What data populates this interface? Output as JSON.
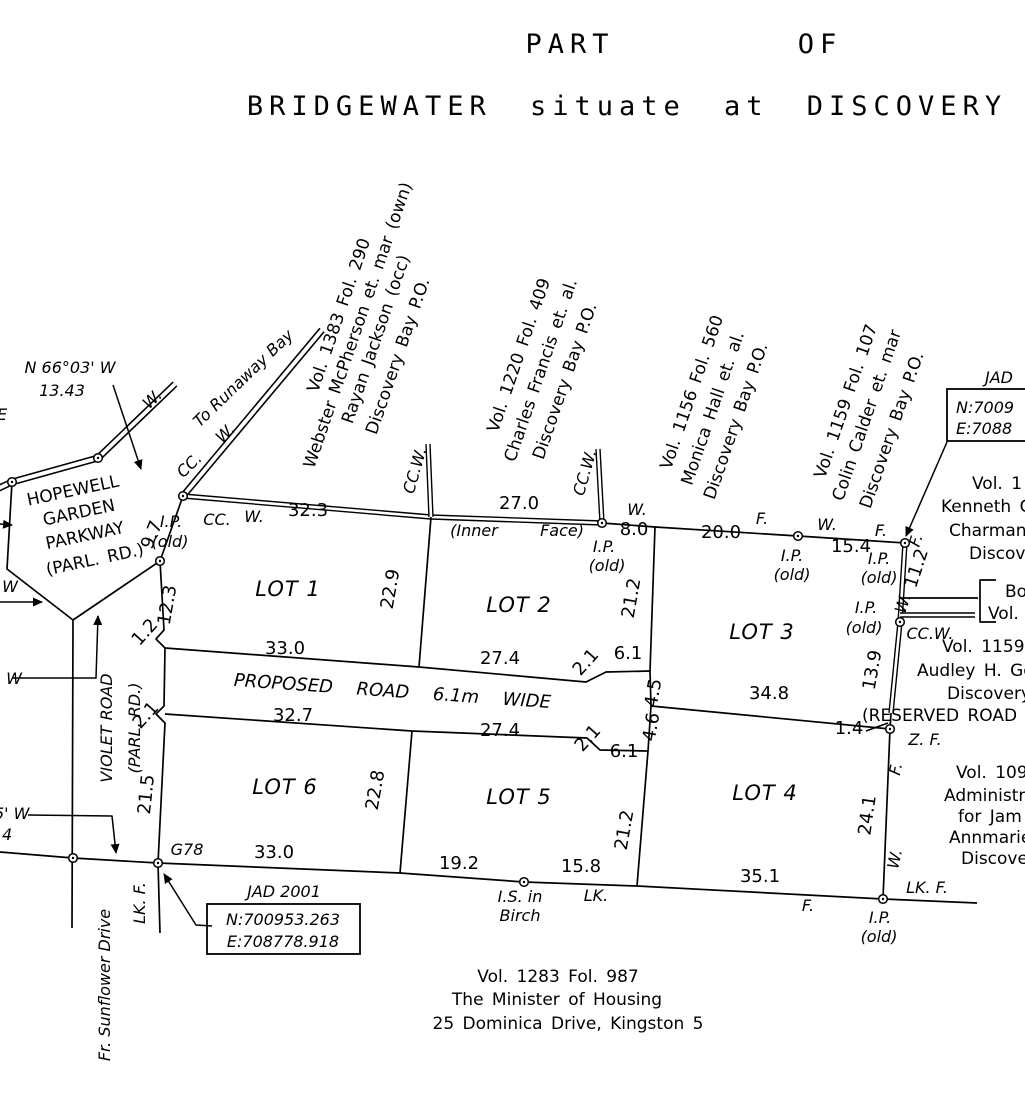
{
  "title": {
    "part": "PART",
    "of": "OF",
    "subtitle": "BRIDGEWATER  situate  at  DISCOVERY"
  },
  "boxes": {
    "jad2001": {
      "caption": "JAD  2001",
      "north": "N:700953.263",
      "east": "E:708778.918"
    },
    "jad_right": {
      "caption": "JAD",
      "north": "N:7009",
      "east": "E:7088"
    }
  },
  "labels": {
    "bearings": [
      {
        "t": "N 66°03' W",
        "x": 70,
        "y": 373,
        "c": "ital"
      },
      {
        "t": "13.43",
        "x": 62,
        "y": 396,
        "c": "ital"
      },
      {
        "t": "E",
        "x": -3,
        "y": 420,
        "c": "ital",
        "a": "s"
      },
      {
        "t": "W",
        "x": 10,
        "y": 592,
        "c": "ital"
      },
      {
        "t": "W",
        "x": 14,
        "y": 684,
        "c": "ital"
      },
      {
        "t": "5'  W",
        "x": -6,
        "y": 819,
        "c": "ital",
        "a": "s"
      },
      {
        "t": "4",
        "x": 2,
        "y": 840,
        "c": "ital",
        "a": "s"
      }
    ],
    "roads": [
      {
        "t": "W.",
        "x": 156,
        "y": 403,
        "r": -44,
        "c": "ital"
      },
      {
        "t": "To Runaway Bay",
        "x": 247,
        "y": 382,
        "r": -44,
        "c": "ital"
      },
      {
        "t": "CC.",
        "x": 193,
        "y": 469,
        "r": -44,
        "c": "ital"
      },
      {
        "t": "W.",
        "x": 229,
        "y": 437,
        "r": -44,
        "c": "ital"
      },
      {
        "t": "HOPEWELL",
        "x": 74,
        "y": 496,
        "r": -12,
        "c": "name"
      },
      {
        "t": "GARDEN",
        "x": 80,
        "y": 518,
        "r": -12,
        "c": "name"
      },
      {
        "t": "PARKWAY",
        "x": 86,
        "y": 541,
        "r": -12,
        "c": "name"
      },
      {
        "t": "(PARL. RD.)",
        "x": 96,
        "y": 565,
        "r": -12,
        "c": "name"
      },
      {
        "t": "VIOLET ROAD",
        "x": 112,
        "y": 728,
        "r": -90,
        "c": "ital"
      },
      {
        "t": "(PARL. RD.)",
        "x": 140,
        "y": 728,
        "r": -90,
        "c": "ital"
      },
      {
        "t": "Fr. Sunflower Drive",
        "x": 110,
        "y": 985,
        "r": -90,
        "c": "ital"
      },
      {
        "t": "PROPOSED   ROAD   6.1m   WIDE",
        "x": 392,
        "y": 697,
        "r": 4,
        "c": "road"
      }
    ],
    "lot_names": [
      {
        "t": "LOT  1",
        "x": 288,
        "y": 596,
        "c": "lot"
      },
      {
        "t": "LOT  2",
        "x": 519,
        "y": 612,
        "c": "lot"
      },
      {
        "t": "LOT  3",
        "x": 762,
        "y": 639,
        "c": "lot"
      },
      {
        "t": "LOT  4",
        "x": 765,
        "y": 800,
        "c": "lot"
      },
      {
        "t": "LOT  5",
        "x": 519,
        "y": 804,
        "c": "lot"
      },
      {
        "t": "LOT  6",
        "x": 285,
        "y": 794,
        "c": "lot"
      }
    ],
    "measurements": [
      {
        "t": "9.7",
        "x": 157,
        "y": 537,
        "r": -68,
        "c": "meas"
      },
      {
        "t": "12.3",
        "x": 173,
        "y": 606,
        "r": -80,
        "c": "meas"
      },
      {
        "t": "1.2",
        "x": 149,
        "y": 636,
        "r": -48,
        "c": "meas"
      },
      {
        "t": "2.1",
        "x": 150,
        "y": 719,
        "r": -48,
        "c": "meas"
      },
      {
        "t": "21.5",
        "x": 152,
        "y": 795,
        "r": -84,
        "c": "meas"
      },
      {
        "t": "32.3",
        "x": 308,
        "y": 516,
        "c": "meas"
      },
      {
        "t": "27.0",
        "x": 519,
        "y": 509,
        "c": "meas"
      },
      {
        "t": "8.0",
        "x": 634,
        "y": 535,
        "c": "meas"
      },
      {
        "t": "20.0",
        "x": 721,
        "y": 538,
        "c": "meas"
      },
      {
        "t": "15.4",
        "x": 851,
        "y": 552,
        "c": "meas"
      },
      {
        "t": "11.2",
        "x": 922,
        "y": 570,
        "r": -72,
        "c": "meas"
      },
      {
        "t": "22.9",
        "x": 396,
        "y": 590,
        "r": -80,
        "c": "meas"
      },
      {
        "t": "21.2",
        "x": 637,
        "y": 599,
        "r": -80,
        "c": "meas"
      },
      {
        "t": "13.9",
        "x": 878,
        "y": 671,
        "r": -80,
        "c": "meas"
      },
      {
        "t": "33.0",
        "x": 285,
        "y": 654,
        "c": "meas"
      },
      {
        "t": "27.4",
        "x": 500,
        "y": 664,
        "c": "meas"
      },
      {
        "t": "2.1",
        "x": 590,
        "y": 666,
        "r": -48,
        "c": "meas"
      },
      {
        "t": "6.1",
        "x": 628,
        "y": 659,
        "c": "meas"
      },
      {
        "t": "32.7",
        "x": 293,
        "y": 721,
        "c": "meas"
      },
      {
        "t": "27.4",
        "x": 500,
        "y": 736,
        "c": "meas"
      },
      {
        "t": "2.1",
        "x": 592,
        "y": 742,
        "r": -48,
        "c": "meas"
      },
      {
        "t": "6.1",
        "x": 624,
        "y": 757,
        "c": "meas"
      },
      {
        "t": "4.5",
        "x": 659,
        "y": 694,
        "r": -80,
        "c": "meas"
      },
      {
        "t": "4.6",
        "x": 657,
        "y": 728,
        "r": -80,
        "c": "meas"
      },
      {
        "t": "34.8",
        "x": 769,
        "y": 699,
        "c": "meas"
      },
      {
        "t": "1.4",
        "x": 849,
        "y": 734,
        "c": "meas"
      },
      {
        "t": "21.2",
        "x": 630,
        "y": 831,
        "r": -80,
        "c": "meas"
      },
      {
        "t": "24.1",
        "x": 873,
        "y": 816,
        "r": -82,
        "c": "meas"
      },
      {
        "t": "22.8",
        "x": 381,
        "y": 791,
        "r": -80,
        "c": "meas"
      },
      {
        "t": "33.0",
        "x": 274,
        "y": 858,
        "c": "meas"
      },
      {
        "t": "19.2",
        "x": 459,
        "y": 869,
        "c": "meas"
      },
      {
        "t": "15.8",
        "x": 581,
        "y": 872,
        "c": "meas"
      },
      {
        "t": "35.1",
        "x": 760,
        "y": 882,
        "c": "meas"
      }
    ],
    "point_marks": [
      {
        "t": "I.P.",
        "x": 171,
        "y": 527,
        "c": "ital"
      },
      {
        "t": "(old)",
        "x": 170,
        "y": 547,
        "c": "ital"
      },
      {
        "t": "CC.",
        "x": 217,
        "y": 525,
        "c": "ital"
      },
      {
        "t": "W.",
        "x": 254,
        "y": 522,
        "c": "ital"
      },
      {
        "t": "CC.W.",
        "x": 420,
        "y": 472,
        "r": -74,
        "c": "ital"
      },
      {
        "t": "(Inner",
        "x": 474,
        "y": 536,
        "c": "ital"
      },
      {
        "t": "Face)",
        "x": 562,
        "y": 536,
        "c": "ital"
      },
      {
        "t": "CC.W.",
        "x": 590,
        "y": 474,
        "r": -74,
        "c": "ital"
      },
      {
        "t": "I.P.",
        "x": 604,
        "y": 552,
        "c": "ital"
      },
      {
        "t": "(old)",
        "x": 607,
        "y": 571,
        "c": "ital"
      },
      {
        "t": "W.",
        "x": 637,
        "y": 515,
        "c": "ital"
      },
      {
        "t": "F.",
        "x": 762,
        "y": 524,
        "c": "ital"
      },
      {
        "t": "I.P.",
        "x": 792,
        "y": 561,
        "c": "ital"
      },
      {
        "t": "(old)",
        "x": 792,
        "y": 580,
        "c": "ital"
      },
      {
        "t": "W.",
        "x": 827,
        "y": 530,
        "c": "ital"
      },
      {
        "t": "I.P.",
        "x": 879,
        "y": 564,
        "c": "ital"
      },
      {
        "t": "(old)",
        "x": 879,
        "y": 583,
        "c": "ital"
      },
      {
        "t": "F.",
        "x": 881,
        "y": 536,
        "c": "ital"
      },
      {
        "t": "F.",
        "x": 921,
        "y": 542,
        "r": -72,
        "c": "ital"
      },
      {
        "t": "W.",
        "x": 908,
        "y": 605,
        "r": -72,
        "c": "ital"
      },
      {
        "t": "I.P.",
        "x": 866,
        "y": 613,
        "c": "ital"
      },
      {
        "t": "(old)",
        "x": 864,
        "y": 633,
        "c": "ital"
      },
      {
        "t": "CC.W.",
        "x": 930,
        "y": 639,
        "c": "ital"
      },
      {
        "t": "Z.  F.",
        "x": 925,
        "y": 745,
        "c": "ital"
      },
      {
        "t": "F.",
        "x": 901,
        "y": 770,
        "r": -78,
        "c": "ital"
      },
      {
        "t": "W.",
        "x": 900,
        "y": 860,
        "r": -78,
        "c": "ital"
      },
      {
        "t": "LK.  F.",
        "x": 927,
        "y": 893,
        "c": "ital"
      },
      {
        "t": "I.P.",
        "x": 880,
        "y": 923,
        "c": "ital"
      },
      {
        "t": "(old)",
        "x": 879,
        "y": 942,
        "c": "ital"
      },
      {
        "t": "LK.",
        "x": 596,
        "y": 901,
        "c": "ital"
      },
      {
        "t": "I.S.  in",
        "x": 520,
        "y": 902,
        "c": "ital"
      },
      {
        "t": "Birch",
        "x": 520,
        "y": 921,
        "c": "ital"
      },
      {
        "t": "F.",
        "x": 808,
        "y": 911,
        "c": "ital"
      },
      {
        "t": "G78",
        "x": 187,
        "y": 855,
        "c": "ital"
      },
      {
        "t": "LK. F.",
        "x": 145,
        "y": 903,
        "r": -90,
        "c": "ital"
      }
    ],
    "owners": [
      {
        "t": "Vol. 1383 Fol. 290",
        "x": 344,
        "y": 317,
        "r": -71,
        "c": "name"
      },
      {
        "t": "Webster McPherson et. mar (own)",
        "x": 363,
        "y": 327,
        "r": -71,
        "c": "name"
      },
      {
        "t": "Rayan Jackson (occ)",
        "x": 381,
        "y": 341,
        "r": -71,
        "c": "name"
      },
      {
        "t": "Discovery Bay P.O.",
        "x": 403,
        "y": 358,
        "r": -71,
        "c": "name"
      },
      {
        "t": "Vol. 1220 Fol. 409",
        "x": 524,
        "y": 357,
        "r": -71,
        "c": "name"
      },
      {
        "t": "Charles Francis et. al.",
        "x": 546,
        "y": 372,
        "r": -71,
        "c": "name"
      },
      {
        "t": "Discovery Bay P.O.",
        "x": 570,
        "y": 383,
        "r": -71,
        "c": "name"
      },
      {
        "t": "Vol. 1156 Fol. 560",
        "x": 697,
        "y": 394,
        "r": -71,
        "c": "name"
      },
      {
        "t": "Monica Hall et. al.",
        "x": 718,
        "y": 410,
        "r": -71,
        "c": "name"
      },
      {
        "t": "Discovery Bay P.O.",
        "x": 741,
        "y": 423,
        "r": -71,
        "c": "name"
      },
      {
        "t": "Vol. 1159 Fol. 107",
        "x": 851,
        "y": 403,
        "r": -71,
        "c": "name"
      },
      {
        "t": "Colin Calder et. mar",
        "x": 872,
        "y": 417,
        "r": -71,
        "c": "name"
      },
      {
        "t": "Discovery Bay P.O.",
        "x": 897,
        "y": 432,
        "r": -71,
        "c": "name"
      }
    ],
    "margin_notes": [
      {
        "t": "Vol. 1",
        "x": 972,
        "y": 489,
        "a": "s",
        "c": "name"
      },
      {
        "t": "Kenneth Ca",
        "x": 941,
        "y": 512,
        "a": "s",
        "c": "name"
      },
      {
        "t": "Charmane",
        "x": 949,
        "y": 536,
        "a": "s",
        "c": "name"
      },
      {
        "t": "Discove",
        "x": 969,
        "y": 559,
        "a": "s",
        "c": "name"
      },
      {
        "t": "Bo",
        "x": 1005,
        "y": 597,
        "a": "s",
        "c": "name"
      },
      {
        "t": "Vol.",
        "x": 988,
        "y": 619,
        "a": "s",
        "c": "name"
      },
      {
        "t": "Vol. 1159",
        "x": 942,
        "y": 652,
        "a": "s",
        "c": "name"
      },
      {
        "t": "Audley H. Gor",
        "x": 917,
        "y": 676,
        "a": "s",
        "c": "name"
      },
      {
        "t": "Discovery",
        "x": 947,
        "y": 699,
        "a": "s",
        "c": "name"
      },
      {
        "t": "(RESERVED ROAD",
        "x": 862,
        "y": 721,
        "a": "s",
        "c": "name"
      },
      {
        "t": "Vol. 109",
        "x": 956,
        "y": 778,
        "a": "s",
        "c": "name"
      },
      {
        "t": "Administrat",
        "x": 944,
        "y": 801,
        "a": "s",
        "c": "name"
      },
      {
        "t": "for Jam",
        "x": 958,
        "y": 822,
        "a": "s",
        "c": "name"
      },
      {
        "t": "Annmarie",
        "x": 949,
        "y": 843,
        "a": "s",
        "c": "name"
      },
      {
        "t": "Discovery",
        "x": 961,
        "y": 864,
        "a": "s",
        "c": "name"
      }
    ],
    "footer": [
      {
        "t": "Vol. 1283 Fol. 987",
        "x": 558,
        "y": 982,
        "c": "name"
      },
      {
        "t": "The Minister of Housing",
        "x": 557,
        "y": 1005,
        "c": "name"
      },
      {
        "t": "25 Dominica Drive, Kingston 5",
        "x": 568,
        "y": 1029,
        "c": "name"
      }
    ]
  },
  "survey_points": [
    [
      12,
      482
    ],
    [
      98,
      458
    ],
    [
      183,
      496
    ],
    [
      160,
      561
    ],
    [
      602,
      523
    ],
    [
      798,
      536
    ],
    [
      905,
      543
    ],
    [
      900,
      622
    ],
    [
      890,
      729
    ],
    [
      883,
      899
    ],
    [
      524,
      882
    ],
    [
      158,
      863
    ],
    [
      73,
      858
    ]
  ]
}
